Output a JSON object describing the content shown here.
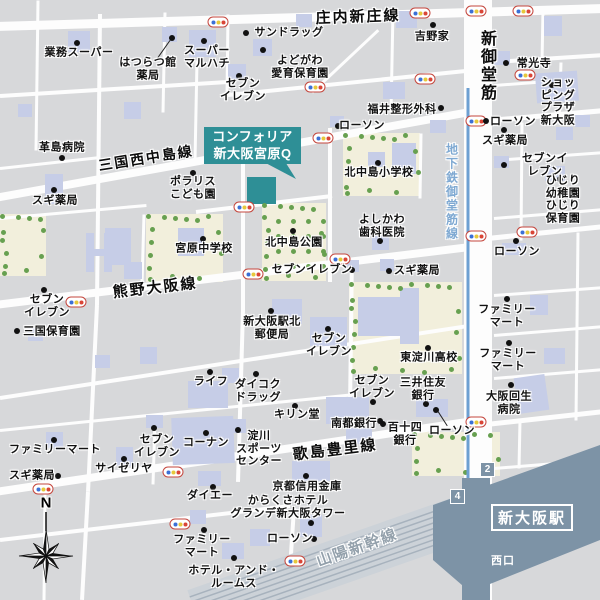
{
  "map": {
    "callout": {
      "lines": [
        "コンフォリア",
        "新大阪宮原Q"
      ]
    },
    "station": {
      "name": "新大阪駅",
      "west_exit": "西口",
      "exit_numbers": [
        "2",
        "4"
      ]
    },
    "compass": {
      "label": "N"
    },
    "road_labels": [
      {
        "label": "庄内新庄線",
        "x": 358,
        "y": 16,
        "rot": -2,
        "size": 15
      },
      {
        "label": "三国西中島線",
        "x": 146,
        "y": 158,
        "rot": -9,
        "size": 14
      },
      {
        "label": "熊野大阪線",
        "x": 155,
        "y": 287,
        "rot": -6.5,
        "size": 15
      },
      {
        "label": "歌島豊里線",
        "x": 335,
        "y": 449,
        "rot": -7,
        "size": 15
      },
      {
        "label": "山陽新幹線",
        "x": 357,
        "y": 547,
        "rot": -19.5,
        "size": 15,
        "color": "#93a0ab"
      },
      {
        "label": "新御堂筋",
        "x": 486,
        "y": 66,
        "rot": 0,
        "size": 16,
        "vertical": true
      },
      {
        "label": "地下鉄御堂筋線",
        "x": 452,
        "y": 192,
        "rot": 0,
        "size": 12,
        "vertical": true,
        "color": "#7fa9d2"
      }
    ],
    "pois": [
      {
        "label": "業務スーパー",
        "x": 79,
        "y": 53,
        "dot": [
          77,
          43
        ]
      },
      {
        "label": "はつらつ館\n薬局",
        "x": 148,
        "y": 69,
        "dot": [
          172,
          38
        ],
        "leader": [
          158,
          58,
          170,
          41
        ]
      },
      {
        "label": "スーパー\nマルハチ",
        "x": 207,
        "y": 57,
        "dot": [
          204,
          41
        ]
      },
      {
        "label": "サンドラッグ",
        "x": 289,
        "y": 33,
        "dot": [
          246,
          33
        ]
      },
      {
        "label": "よどがわ\n愛育保育園",
        "x": 300,
        "y": 67,
        "dot": [
          263,
          50
        ]
      },
      {
        "label": "セブン\nイレブン",
        "x": 243,
        "y": 90,
        "dot": [
          239,
          76
        ]
      },
      {
        "label": "吉野家",
        "x": 432,
        "y": 37,
        "dot": [
          433,
          25
        ]
      },
      {
        "label": "常光寺",
        "x": 534,
        "y": 64,
        "dot": [
          506,
          63
        ]
      },
      {
        "label": "ショッピング\nプラザ新大阪",
        "x": 558,
        "y": 102,
        "dot": [
          552,
          85
        ]
      },
      {
        "label": "ローソン",
        "x": 513,
        "y": 122,
        "dot": [
          486,
          121
        ]
      },
      {
        "label": "スギ薬局",
        "x": 505,
        "y": 141,
        "dot": [
          504,
          130
        ]
      },
      {
        "label": "セブンイレブン",
        "x": 545,
        "y": 165,
        "dot": [
          504,
          165
        ]
      },
      {
        "label": "ひじり幼稚園\nひじり保育園",
        "x": 563,
        "y": 200,
        "dot": [
          560,
          179
        ]
      },
      {
        "label": "ローソン",
        "x": 517,
        "y": 252,
        "dot": [
          516,
          241
        ]
      },
      {
        "label": "福井整形外科",
        "x": 402,
        "y": 110,
        "dot": [
          441,
          108
        ]
      },
      {
        "label": "ローソン",
        "x": 362,
        "y": 126,
        "dot": [
          338,
          126
        ]
      },
      {
        "label": "革島病院",
        "x": 62,
        "y": 148,
        "dot": [
          62,
          158
        ]
      },
      {
        "label": "スギ薬局",
        "x": 55,
        "y": 201,
        "dot": [
          54,
          190
        ]
      },
      {
        "label": "ポラリス\nこども園",
        "x": 193,
        "y": 188,
        "dot": [
          193,
          173
        ]
      },
      {
        "label": "宮原中学校",
        "x": 204,
        "y": 249,
        "dot": [
          203,
          239
        ]
      },
      {
        "label": "北中島公園",
        "x": 294,
        "y": 243,
        "dot": [
          293,
          231
        ]
      },
      {
        "label": "北中島小学校",
        "x": 379,
        "y": 173,
        "dot": [
          378,
          163
        ]
      },
      {
        "label": "よしかわ\n歯科医院",
        "x": 382,
        "y": 226,
        "dot": [
          380,
          241
        ]
      },
      {
        "label": "セブンイレブン",
        "x": 312,
        "y": 270,
        "dot": [
          352,
          270
        ]
      },
      {
        "label": "スギ薬局",
        "x": 417,
        "y": 271,
        "dot": [
          389,
          271
        ]
      },
      {
        "label": "セブン\nイレブン",
        "x": 47,
        "y": 306,
        "dot": [
          44,
          290
        ]
      },
      {
        "label": "三国保育園",
        "x": 52,
        "y": 332,
        "dot": [
          17,
          331
        ]
      },
      {
        "label": "新大阪駅北\n郵便局",
        "x": 272,
        "y": 328,
        "dot": [
          271,
          311
        ]
      },
      {
        "label": "セブン\nイレブン",
        "x": 329,
        "y": 345,
        "dot": [
          328,
          329
        ]
      },
      {
        "label": "東淀川高校",
        "x": 429,
        "y": 358,
        "dot": [
          428,
          348
        ]
      },
      {
        "label": "ファミリー\nマート",
        "x": 507,
        "y": 316,
        "dot": [
          507,
          299
        ]
      },
      {
        "label": "ファミリー\nマート",
        "x": 508,
        "y": 360,
        "dot": [
          509,
          343
        ]
      },
      {
        "label": "大阪回生\n病院",
        "x": 509,
        "y": 403,
        "dot": [
          511,
          385
        ]
      },
      {
        "label": "ライフ",
        "x": 211,
        "y": 382,
        "dot": [
          210,
          372
        ]
      },
      {
        "label": "ダイコク\nドラッグ",
        "x": 258,
        "y": 391,
        "dot": [
          256,
          374
        ]
      },
      {
        "label": "キリン堂",
        "x": 297,
        "y": 415,
        "dot": [
          295,
          406
        ]
      },
      {
        "label": "セブン\nイレブン",
        "x": 372,
        "y": 387,
        "dot": [
          373,
          402
        ]
      },
      {
        "label": "三井住友\n銀行",
        "x": 423,
        "y": 389,
        "dot": [
          426,
          404
        ]
      },
      {
        "label": "南都銀行",
        "x": 354,
        "y": 424,
        "dot": [
          383,
          424
        ]
      },
      {
        "label": "百十四\n銀行",
        "x": 405,
        "y": 434,
        "dot": [
          380,
          421
        ]
      },
      {
        "label": "ローソン",
        "x": 452,
        "y": 431,
        "dot": [
          436,
          410
        ],
        "leader": [
          438,
          412,
          447,
          426
        ]
      },
      {
        "label": "ファミリーマート",
        "x": 55,
        "y": 450,
        "dot": [
          54,
          440
        ]
      },
      {
        "label": "スギ薬局",
        "x": 32,
        "y": 476,
        "dot": [
          58,
          476
        ]
      },
      {
        "label": "サイゼリヤ",
        "x": 124,
        "y": 469,
        "dot": [
          124,
          459
        ]
      },
      {
        "label": "セブン\nイレブン",
        "x": 157,
        "y": 446,
        "dot": [
          154,
          428
        ]
      },
      {
        "label": "コーナン",
        "x": 206,
        "y": 443,
        "dot": [
          206,
          433
        ]
      },
      {
        "label": "ダイエー",
        "x": 210,
        "y": 496,
        "dot": [
          213,
          487
        ]
      },
      {
        "label": "淀川\nスポーツ\nセンター",
        "x": 259,
        "y": 449,
        "dot": [
          238,
          430
        ]
      },
      {
        "label": "京都信用金庫",
        "x": 307,
        "y": 487,
        "dot": [
          306,
          476
        ]
      },
      {
        "label": "からくさホテル\nグランデ新大阪タワー",
        "x": 288,
        "y": 507,
        "dot": [
          311,
          523
        ]
      },
      {
        "label": "ローソン",
        "x": 290,
        "y": 539,
        "dot": [
          314,
          539
        ]
      },
      {
        "label": "ファミリー\nマート",
        "x": 202,
        "y": 546,
        "dot": [
          204,
          530
        ]
      },
      {
        "label": "ホテル・アンド・\nルームス",
        "x": 234,
        "y": 577,
        "dot": [
          234,
          558
        ]
      }
    ],
    "signals": [
      [
        218,
        22
      ],
      [
        420,
        13
      ],
      [
        476,
        11
      ],
      [
        523,
        11
      ],
      [
        315,
        87
      ],
      [
        425,
        79
      ],
      [
        525,
        75
      ],
      [
        476,
        121
      ],
      [
        323,
        138
      ],
      [
        244,
        207
      ],
      [
        340,
        259
      ],
      [
        253,
        274
      ],
      [
        76,
        302
      ],
      [
        476,
        236
      ],
      [
        527,
        232
      ],
      [
        476,
        422
      ],
      [
        173,
        472
      ],
      [
        43,
        489
      ],
      [
        180,
        524
      ],
      [
        295,
        561
      ]
    ],
    "colors": {
      "road": "#fdfdfd",
      "block": "#d7d8da",
      "building": "#c6cde7",
      "park": "#f2efdc",
      "tree": "#67a050",
      "station": "#7d93a6",
      "subway": "#6da0d2",
      "callout": "#2e8f96",
      "rail_bg": "#ccd2d8",
      "rail_stripe": "#a7b2bd",
      "signal_border": "#c4463d",
      "signal_blue": "#3b6fd6",
      "signal_yellow": "#e6c83c",
      "signal_red": "#d94536"
    }
  }
}
